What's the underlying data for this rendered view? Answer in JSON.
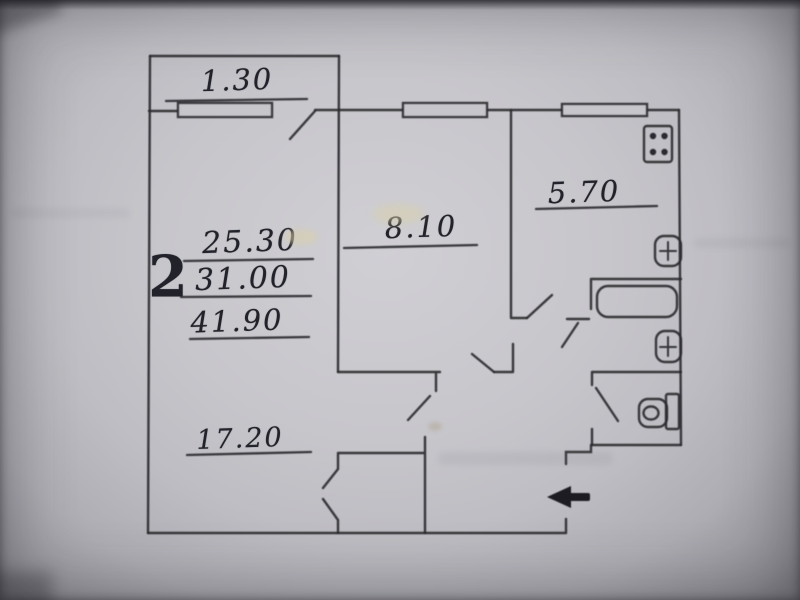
{
  "photo": {
    "paper_color": "#c7c6cb",
    "ink_color": "#2a2a30"
  },
  "plan": {
    "summary": {
      "rooms_count": "2",
      "living_area": "25.30",
      "living_plus_kitchen_area": "31.00",
      "total_area": "41.90"
    },
    "labels": {
      "balcony_width": "1.30",
      "living_room_area": "17.20",
      "second_room_area": "8.10",
      "kitchen_area": "5.70"
    },
    "fixtures": {
      "stove": "stove-icon",
      "kitchen_sink": "sink-icon",
      "bathtub": "bathtub-icon",
      "bathroom_sink": "sink-icon",
      "toilet": "toilet-icon",
      "entrance": "entrance-arrow-icon"
    }
  }
}
